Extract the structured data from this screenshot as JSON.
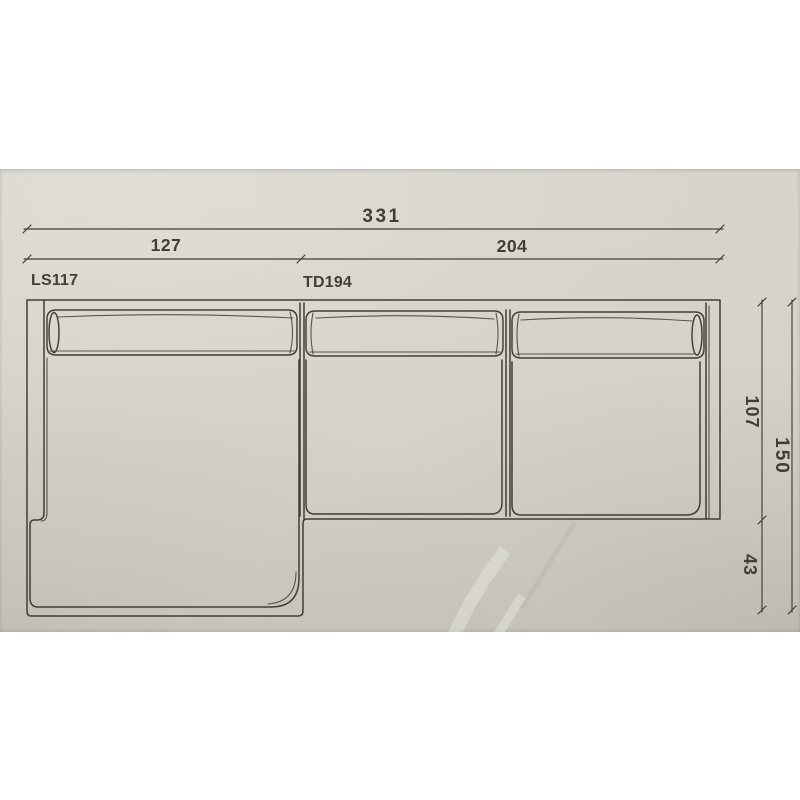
{
  "theme": {
    "page-bg": "#ffffff",
    "paper": "#d8d5cc",
    "ink": "#413e37"
  },
  "photo": {
    "description": "photograph of a sectional sofa technical plan drawing"
  },
  "drawing": {
    "module_labels": {
      "chaise": "LS117",
      "sofa": "TD194"
    },
    "dimensions": {
      "total_width": "331",
      "chaise_width": "127",
      "sofa_width": "204",
      "sofa_depth": "107",
      "total_depth": "150",
      "chaise_extension": "43"
    }
  }
}
